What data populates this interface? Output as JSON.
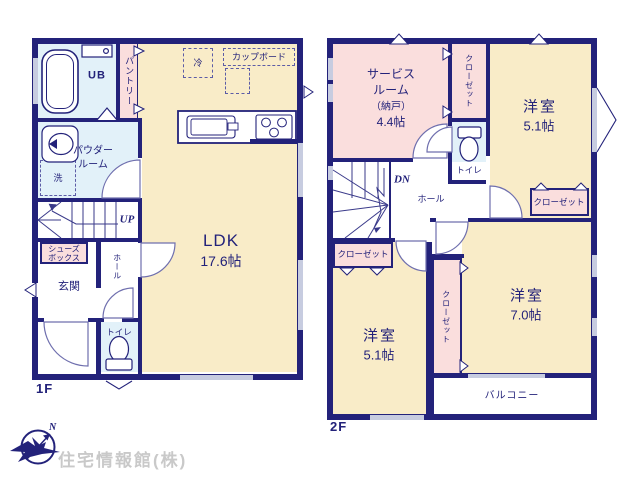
{
  "floor1": {
    "floor_label": "1F",
    "ldk_name": "LDK",
    "ldk_size": "17.6帖",
    "ub": "UB",
    "pantry": "パントリー",
    "fridge": "冷",
    "cupboard": "カップボード",
    "powder_line1": "パウダー",
    "powder_line2": "ルーム",
    "laundry": "洗",
    "stairs_dir": "UP",
    "shoes_line1": "シューズ",
    "shoes_line2": "ボックス",
    "genkan": "玄関",
    "hall": "ホール",
    "toilet": "トイレ"
  },
  "floor2": {
    "floor_label": "2F",
    "service_line1": "サービス",
    "service_line2": "ルーム",
    "service_line3": "（納戸）",
    "service_size": "4.4帖",
    "closet_top": "クローゼット",
    "toilet": "トイレ",
    "bedroom_ne_name": "洋室",
    "bedroom_ne_size": "5.1帖",
    "closet_ne": "クローゼット",
    "stairs_dir": "DN",
    "hall": "ホール",
    "closet_w": "クローゼット",
    "bedroom_sw_name": "洋室",
    "bedroom_sw_size": "5.1帖",
    "closet_mid": "クローゼット",
    "bedroom_se_name": "洋室",
    "bedroom_se_size": "7.0帖",
    "balcony": "バルコニー"
  },
  "footer": {
    "compass_north": "N",
    "company": "住宅情報館(株)"
  },
  "colors": {
    "wall": "#23227a",
    "room_cream": "#f9ecc8",
    "room_pink": "#fadedd",
    "room_blue": "#e2f1f9",
    "window": "#c7cce0",
    "logo_gray": "#c9c9c9"
  }
}
